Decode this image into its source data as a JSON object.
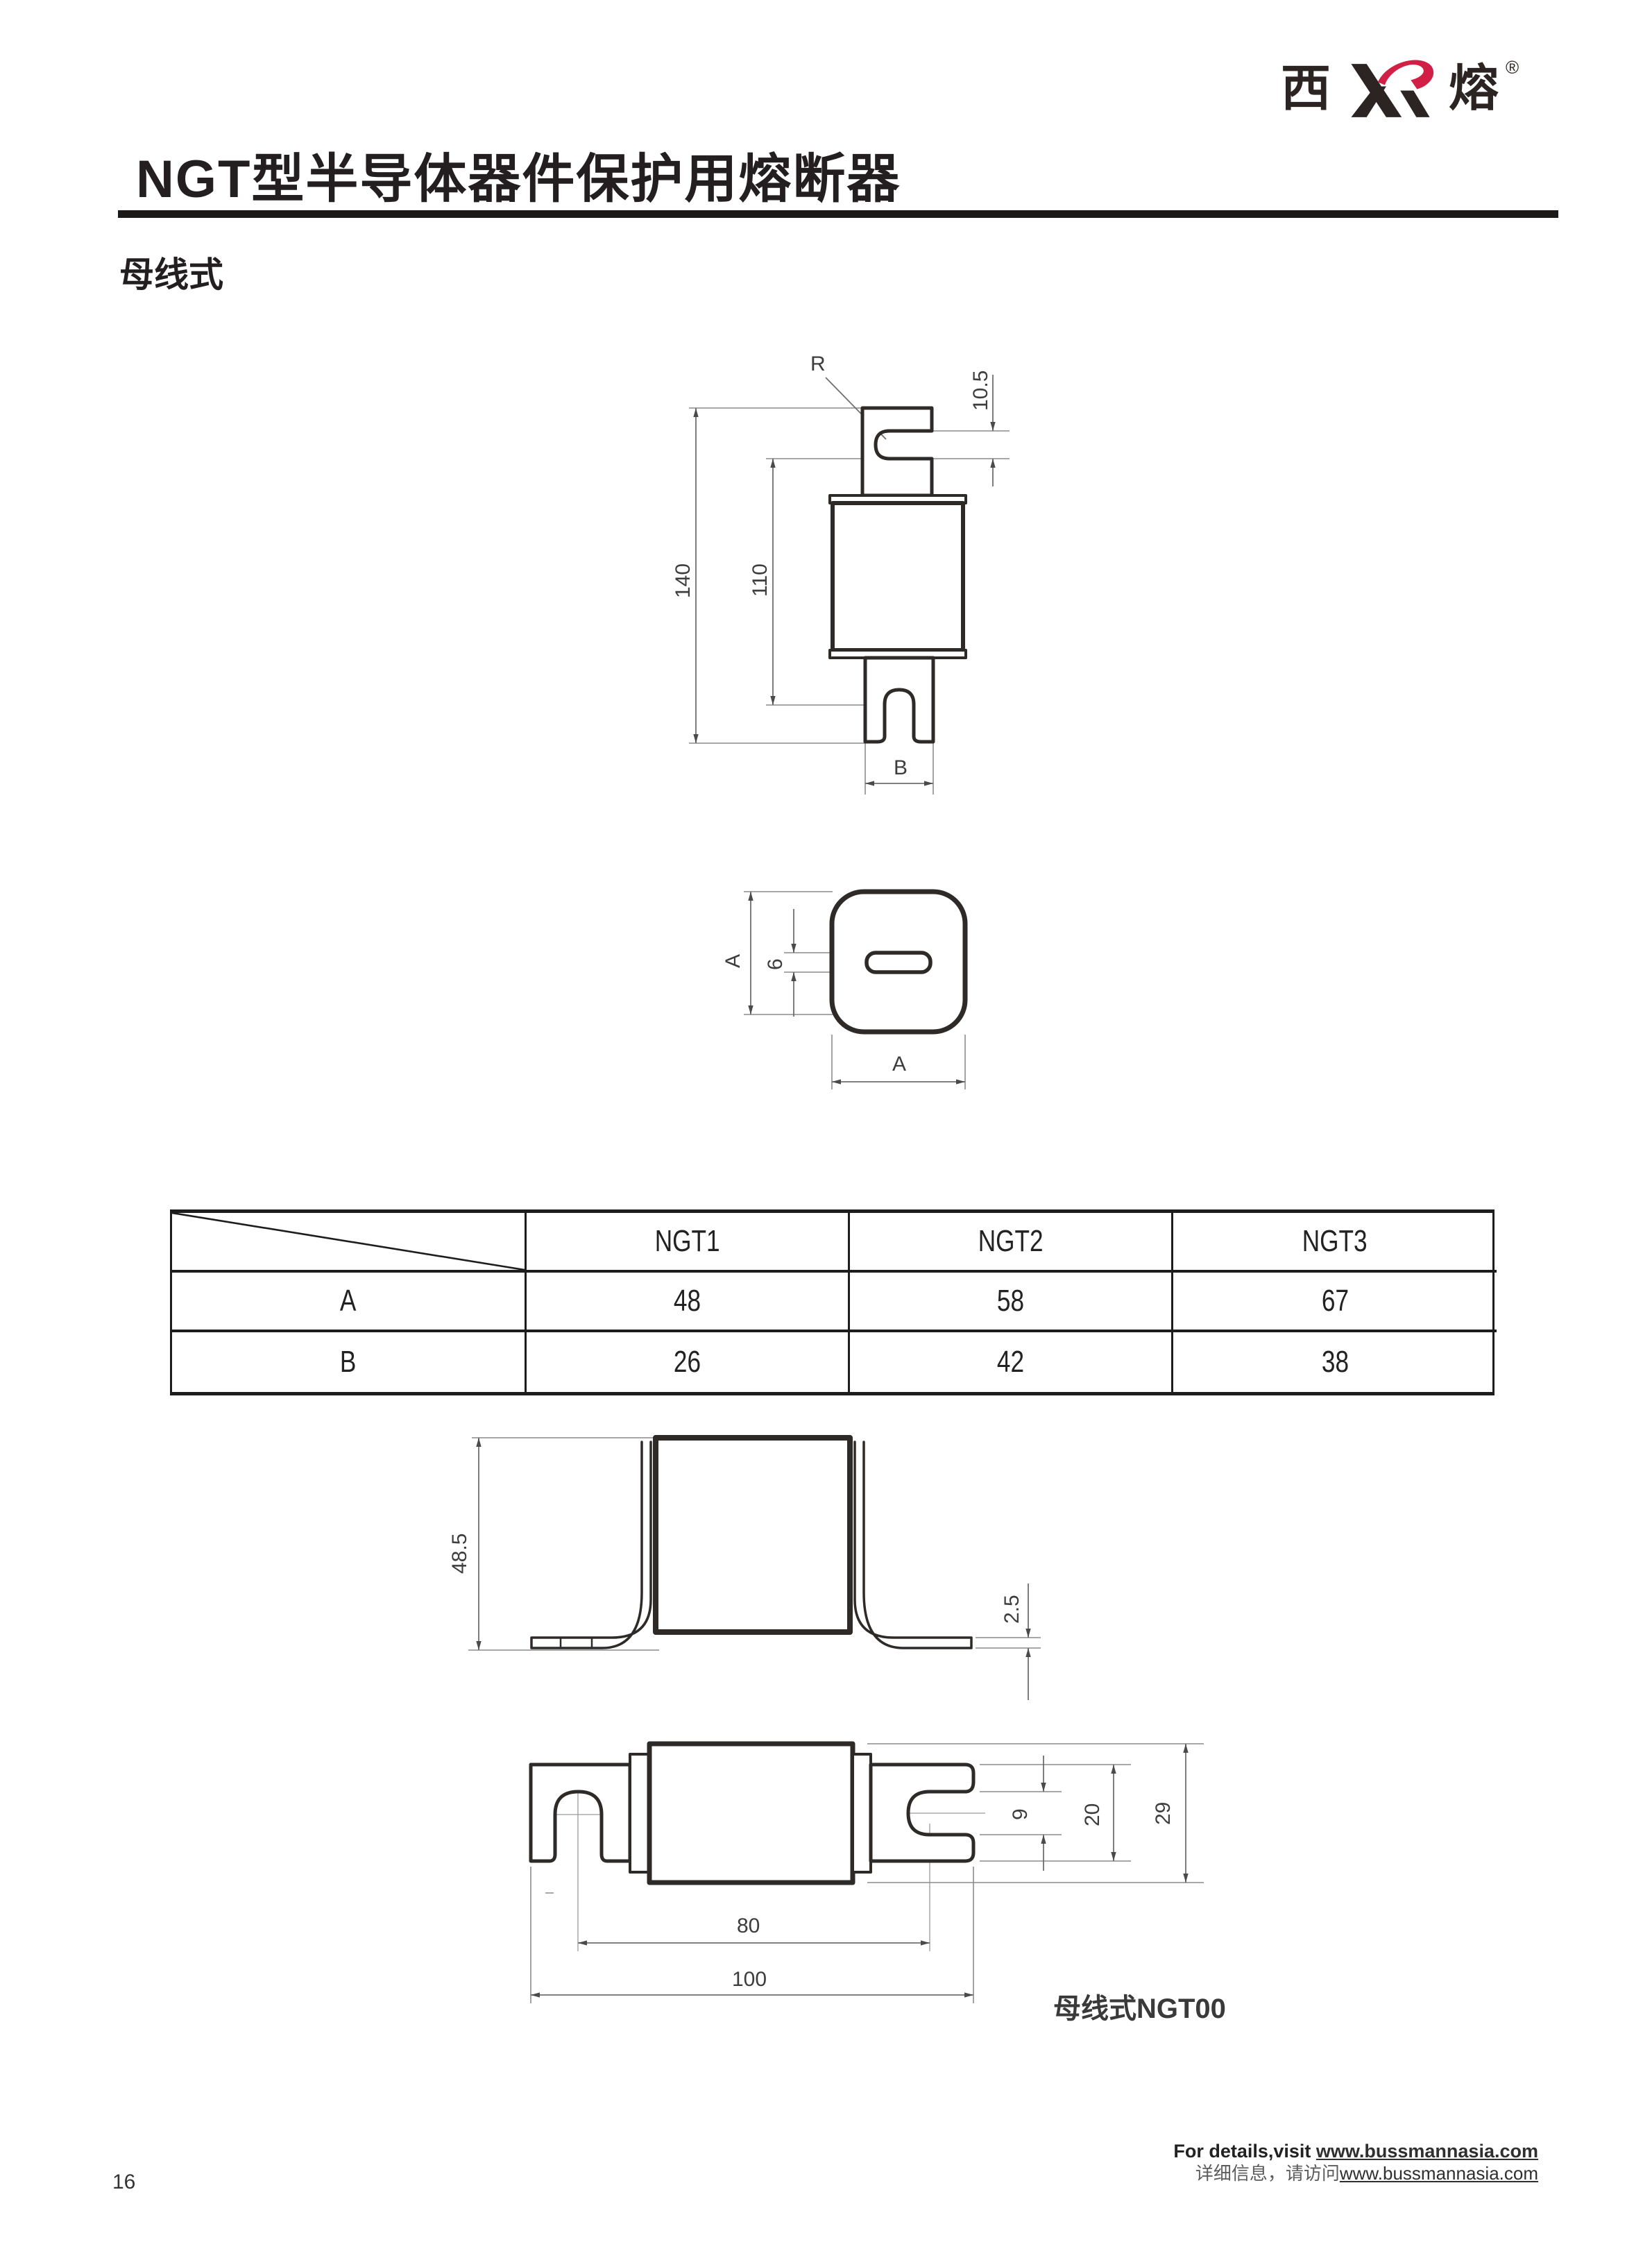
{
  "page": {
    "number": "16"
  },
  "logo": {
    "left_char": "西",
    "right_char": "熔",
    "registered": "®",
    "red": "#d21f45",
    "dark": "#2b2423"
  },
  "header": {
    "title": "NGT型半导体器件保护用熔断器",
    "subtitle": "母线式"
  },
  "drawings": {
    "side": {
      "r": "R",
      "h105": "10.5",
      "h140": "140",
      "h110": "110",
      "b": "B"
    },
    "top": {
      "a_left": "A",
      "w6": "6",
      "a_bottom": "A"
    },
    "front": {
      "h485": "48.5",
      "t25": "2.5"
    },
    "bus00": {
      "d9": "9",
      "d20": "20",
      "d29": "29",
      "d80": "80",
      "d100": "100",
      "caption": "母线式NGT00"
    }
  },
  "table": {
    "corner": "",
    "headers": [
      "NGT1",
      "NGT2",
      "NGT3"
    ],
    "rows": [
      {
        "label": "A",
        "values": [
          "48",
          "58",
          "67"
        ]
      },
      {
        "label": "B",
        "values": [
          "26",
          "42",
          "38"
        ]
      }
    ]
  },
  "footer": {
    "en_prefix": "For details,visit ",
    "en_url": "www.bussmannasia.com",
    "cn_prefix": "详细信息，请访问",
    "cn_url": "www.bussmannasia.com"
  }
}
